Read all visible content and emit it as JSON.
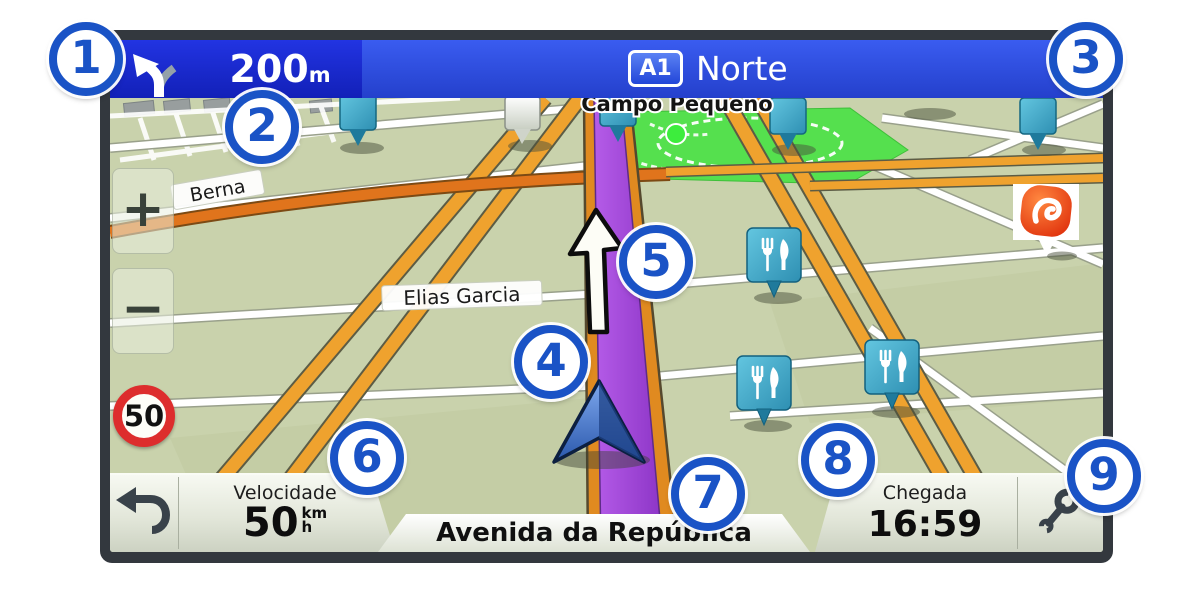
{
  "nav_bar": {
    "turn_icon": "fork-left-arrow",
    "distance": "200",
    "distance_unit": "m",
    "road_badge": "A1",
    "road_name": "Norte",
    "bg_left": "#1a26c6",
    "bg_right": "#2d4fe0"
  },
  "map": {
    "street_label_1": "Berna",
    "street_label_2": "Elias Garcia",
    "area_label": "Campo Pequeno",
    "speed_limit": "50",
    "zoom_in": "+",
    "zoom_out": "−",
    "route_color": "#9b3fd4",
    "park_color": "#55e04e",
    "poi_icons": [
      "restaurant-pin",
      "restaurant-pin",
      "restaurant-pin",
      "fuel-brand-pin"
    ]
  },
  "status_bar": {
    "back_icon": "back-arrow",
    "speed_label": "Velocidade",
    "speed_value": "50",
    "speed_unit_top": "km",
    "speed_unit_bottom": "h",
    "street_name": "Avenida da República",
    "arrival_label": "Chegada",
    "arrival_time": "16:59",
    "tools_icon": "wrench"
  },
  "callouts": [
    "1",
    "2",
    "3",
    "4",
    "5",
    "6",
    "7",
    "8",
    "9"
  ]
}
